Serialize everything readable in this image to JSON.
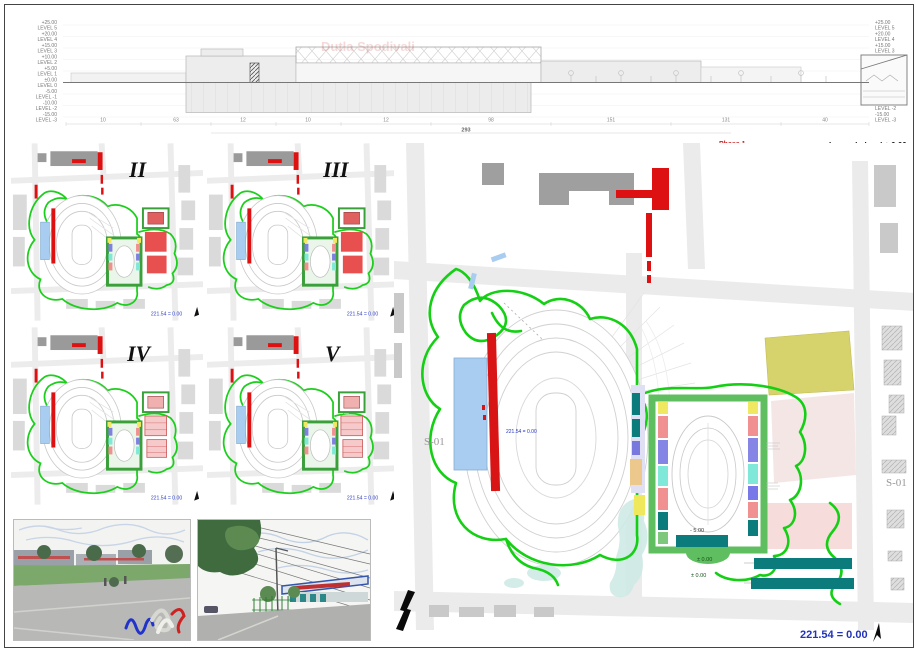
{
  "section": {
    "watermark": "Dutla Spodivali",
    "levels": [
      {
        "elev": "+25.00",
        "name": "LEVEL 5"
      },
      {
        "elev": "+20.00",
        "name": "LEVEL 4"
      },
      {
        "elev": "+15.00",
        "name": "LEVEL 3"
      },
      {
        "elev": "+10.00",
        "name": "LEVEL 2"
      },
      {
        "elev": "+5.00",
        "name": "LEVEL 1"
      },
      {
        "elev": "±0.00",
        "name": "LEVEL 0"
      },
      {
        "elev": "-5.00",
        "name": "LEVEL -1"
      },
      {
        "elev": "-10.00",
        "name": "LEVEL -2"
      },
      {
        "elev": "-15.00",
        "name": "LEVEL -3"
      }
    ],
    "dim_row": [
      "10",
      "63",
      "12",
      "10",
      "12",
      "98",
      "151",
      "131",
      "40"
    ],
    "dim_total": "293"
  },
  "phases": [
    {
      "numeral": "II",
      "caption": "221.54 = 0.00"
    },
    {
      "numeral": "III",
      "caption": "221.54 = 0.00"
    },
    {
      "numeral": "IV",
      "caption": "221.54 = 0.00"
    },
    {
      "numeral": "V",
      "caption": "221.54 = 0.00"
    }
  ],
  "phase1_legend": {
    "title": "Phase 1",
    "items": [
      {
        "label": "structures to be kept as-is",
        "color": "#f0a0a0"
      },
      {
        "label": "structures to be dismantled",
        "color": "#0c7b7b"
      },
      {
        "label": "stadium area - structures new school - suggested extension location",
        "color": "#dd1111"
      },
      {
        "label": "stadium area - as-is to be kept",
        "color": "#a9cdf0"
      },
      {
        "label": "running curcuit - optional",
        "color": "#15cf15"
      },
      {
        "label": "temporary car parking",
        "color": "#d6d26c"
      },
      {
        "label": "land use not solved yet",
        "color": "#ffffff"
      },
      {
        "label": "neighbourhood buildings",
        "color": "#e3e3e3"
      },
      {
        "label": "access / shipping / fire fighting construction / emergency road",
        "color": "#dcdcdc"
      }
    ]
  },
  "level_legend": {
    "title": "Legend - level ± 0.00",
    "items": [
      {
        "label": "circulation",
        "color": "#7dc87d"
      },
      {
        "label": "stair / elevator",
        "color": "#f0f060"
      },
      {
        "label": "maintenance",
        "color": "#f5c9a0"
      },
      {
        "label": "tribune",
        "color": "#f08080"
      },
      {
        "label": "storage outdoor",
        "color": "#80ffe8"
      },
      {
        "label": "underground parking",
        "color": "#dcdcf5"
      },
      {
        "label": "WC",
        "color": "#7878e8"
      },
      {
        "label": "engineering rooms",
        "color": "#8fe0d0"
      }
    ]
  },
  "main_plan": {
    "s01_left": "S-01",
    "s01_right": "S-01",
    "datum": "221.54 = 0.00",
    "track_level": "- 5.00",
    "plaza_level_1": "± 0.00",
    "plaza_level_2": "± 0.00"
  },
  "footer": {
    "datum": "221.54 = 0.00"
  }
}
